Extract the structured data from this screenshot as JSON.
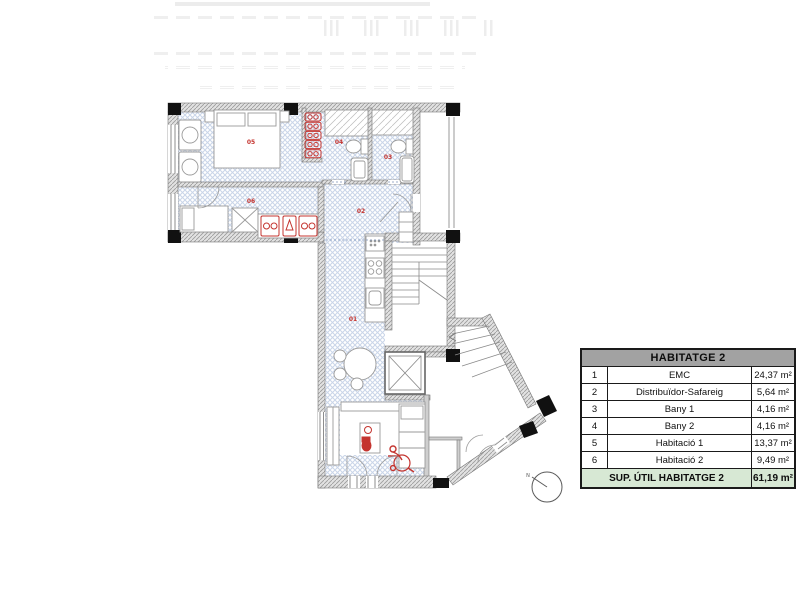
{
  "plan": {
    "rooms": [
      {
        "number": "01"
      },
      {
        "number": "02"
      },
      {
        "number": "03"
      },
      {
        "number": "04"
      },
      {
        "number": "05"
      },
      {
        "number": "06"
      }
    ],
    "compass_label": "N",
    "colors": {
      "floor_hatch": "#c9d5e9",
      "wall_fill": "#e2e2e2",
      "accent_red": "#c4342f",
      "column_black": "#111111"
    }
  },
  "area_table": {
    "title": "HABITATGE 2",
    "rows": [
      {
        "num": "1",
        "name": "EMC",
        "area": "24,37 m²"
      },
      {
        "num": "2",
        "name": "Distribuïdor-Safareig",
        "area": "5,64 m²"
      },
      {
        "num": "3",
        "name": "Bany 1",
        "area": "4,16 m²"
      },
      {
        "num": "4",
        "name": "Bany 2",
        "area": "4,16 m²"
      },
      {
        "num": "5",
        "name": "Habitació 1",
        "area": "13,37 m²"
      },
      {
        "num": "6",
        "name": "Habitació 2",
        "area": "9,49 m²"
      }
    ],
    "footer": {
      "label": "SUP. ÚTIL HABITATGE 2",
      "value": "61,19 m²"
    }
  }
}
